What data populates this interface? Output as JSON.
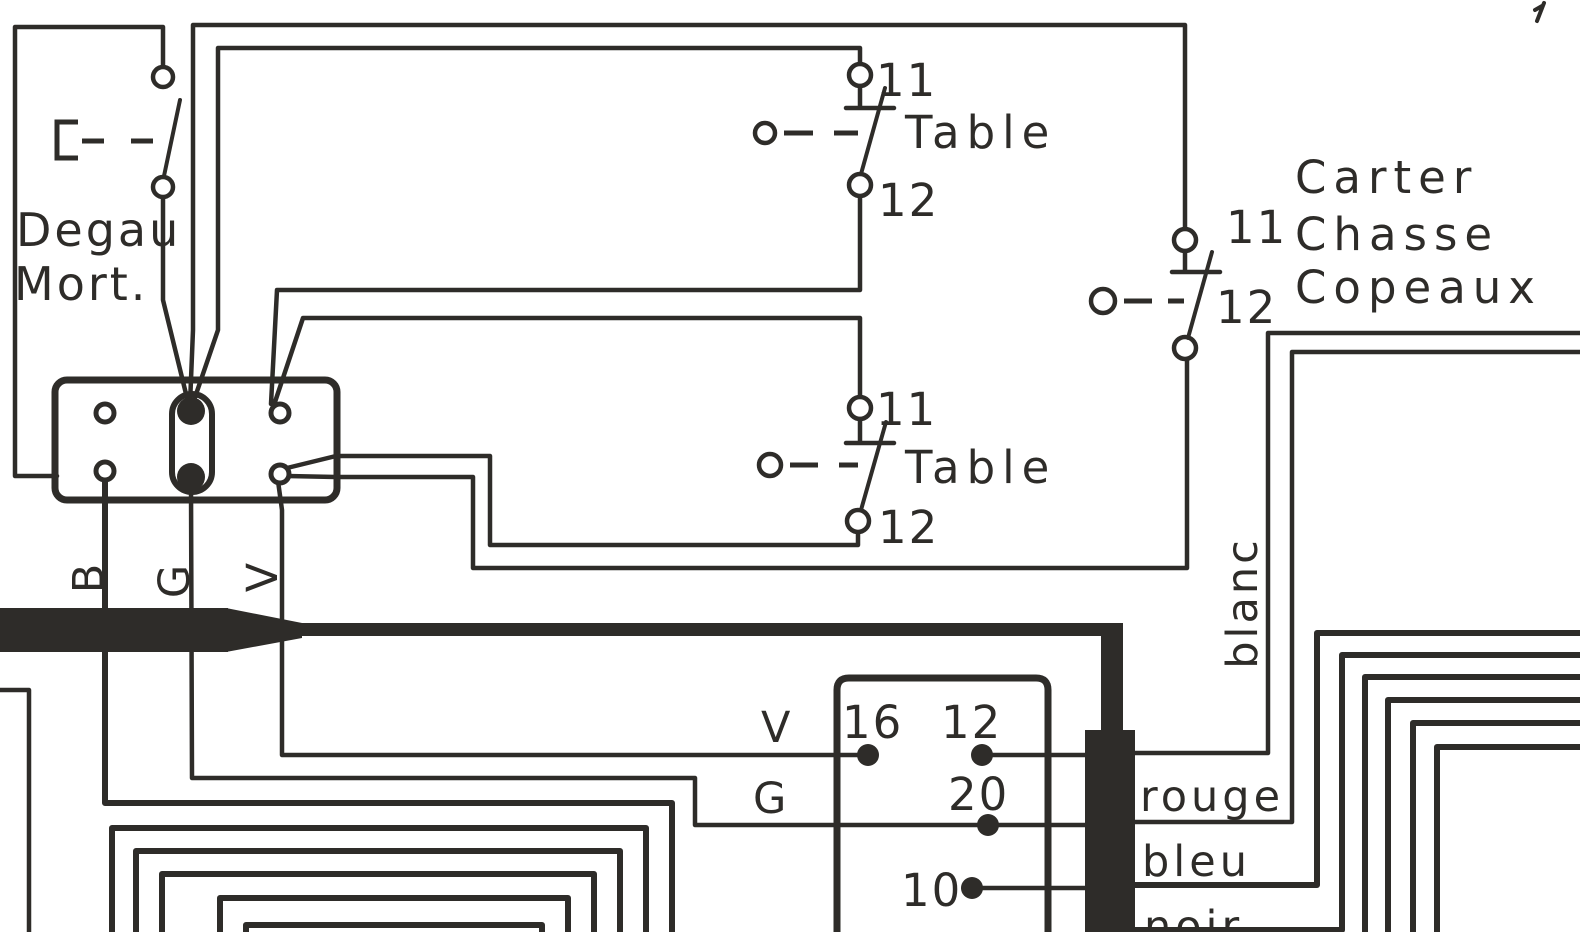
{
  "diagram": {
    "colors": {
      "ink": "#2e2c29",
      "paper": "#ffffff"
    },
    "device_labels": {
      "degau_line1": "Degau",
      "degau_line2": "Mort.",
      "carter_line1": "Carter",
      "carter_line2": "Chasse",
      "carter_line3": "Copeaux"
    },
    "switches": {
      "table_top": {
        "contact_top": "11",
        "contact_bottom": "12",
        "label": "Table"
      },
      "table_mid": {
        "contact_top": "11",
        "contact_bottom": "12",
        "label": "Table"
      },
      "carter": {
        "contact_top": "11",
        "contact_bottom": "12"
      }
    },
    "conductor_labels": {
      "b": "B",
      "g": "G",
      "v": "V",
      "v_mid": "V",
      "g_mid": "G",
      "blanc": "blanc",
      "rouge": "rouge",
      "bleu": "bleu",
      "noir": "noir"
    },
    "junction_box_terminals": {
      "t16": "16",
      "t12": "12",
      "t20": "20",
      "t10": "10"
    }
  }
}
